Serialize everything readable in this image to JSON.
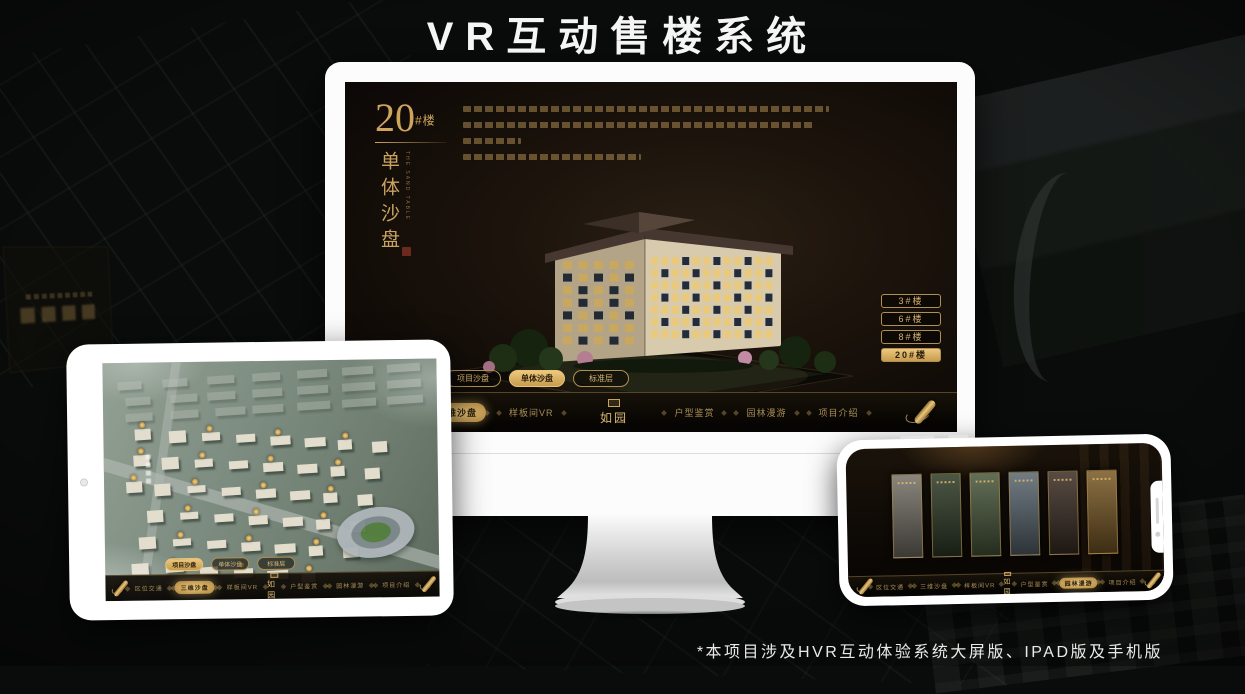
{
  "page": {
    "title": "VR互动售楼系统",
    "footnote": "*本项目涉及HVR互动体验系统大屏版、IPAD版及手机版"
  },
  "colors": {
    "gold": "#d3aa64",
    "gold_bright": "#e9c87e",
    "active_text": "#2b1d0c",
    "screen_bg": "#17100a",
    "monitor_shell": "#fcfcfc"
  },
  "brand": {
    "logo_text": "如园"
  },
  "desktop_app": {
    "section": {
      "number": "20",
      "suffix": "#楼",
      "title_vertical": "单体沙盘",
      "subtitle_en": "THE SAND TABLE"
    },
    "building_buttons": [
      {
        "label": "3#楼",
        "active": false
      },
      {
        "label": "6#楼",
        "active": false
      },
      {
        "label": "8#楼",
        "active": false
      },
      {
        "label": "20#楼",
        "active": true
      }
    ],
    "tabs": [
      {
        "label": "项目沙盘",
        "active": false
      },
      {
        "label": "单体沙盘",
        "active": true
      },
      {
        "label": "标准层",
        "active": false
      }
    ],
    "menu_left": [
      {
        "label": "区位交通",
        "active": false
      },
      {
        "label": "三维沙盘",
        "active": true
      },
      {
        "label": "样板间VR",
        "active": false
      }
    ],
    "menu_right": [
      {
        "label": "户型鉴赏",
        "active": false
      },
      {
        "label": "园林漫游",
        "active": false
      },
      {
        "label": "项目介绍",
        "active": false
      }
    ]
  },
  "ipad_app": {
    "tabs": [
      {
        "label": "项目沙盘",
        "active": true
      },
      {
        "label": "单体沙盘",
        "active": false
      },
      {
        "label": "标准层",
        "active": false
      }
    ],
    "menu_left": [
      {
        "label": "区位交通",
        "active": false
      },
      {
        "label": "三维沙盘",
        "active": true
      },
      {
        "label": "样板间VR",
        "active": false
      }
    ],
    "menu_right": [
      {
        "label": "户型鉴赏",
        "active": false
      },
      {
        "label": "园林漫游",
        "active": false
      },
      {
        "label": "项目介绍",
        "active": false
      }
    ],
    "marker_count": 22
  },
  "phone_app": {
    "menu_left": [
      {
        "label": "区位交通",
        "active": false
      },
      {
        "label": "三维沙盘",
        "active": false
      },
      {
        "label": "样板间VR",
        "active": false
      }
    ],
    "menu_right": [
      {
        "label": "户型鉴赏",
        "active": false
      },
      {
        "label": "园林漫游",
        "active": true
      },
      {
        "label": "项目介绍",
        "active": false
      }
    ],
    "gallery_panels": [
      {
        "tone": "#767268"
      },
      {
        "tone": "#2f3b27"
      },
      {
        "tone": "#49583c"
      },
      {
        "tone": "#5a676f"
      },
      {
        "tone": "#3c2f25"
      },
      {
        "tone": "#7a5a26"
      }
    ]
  }
}
